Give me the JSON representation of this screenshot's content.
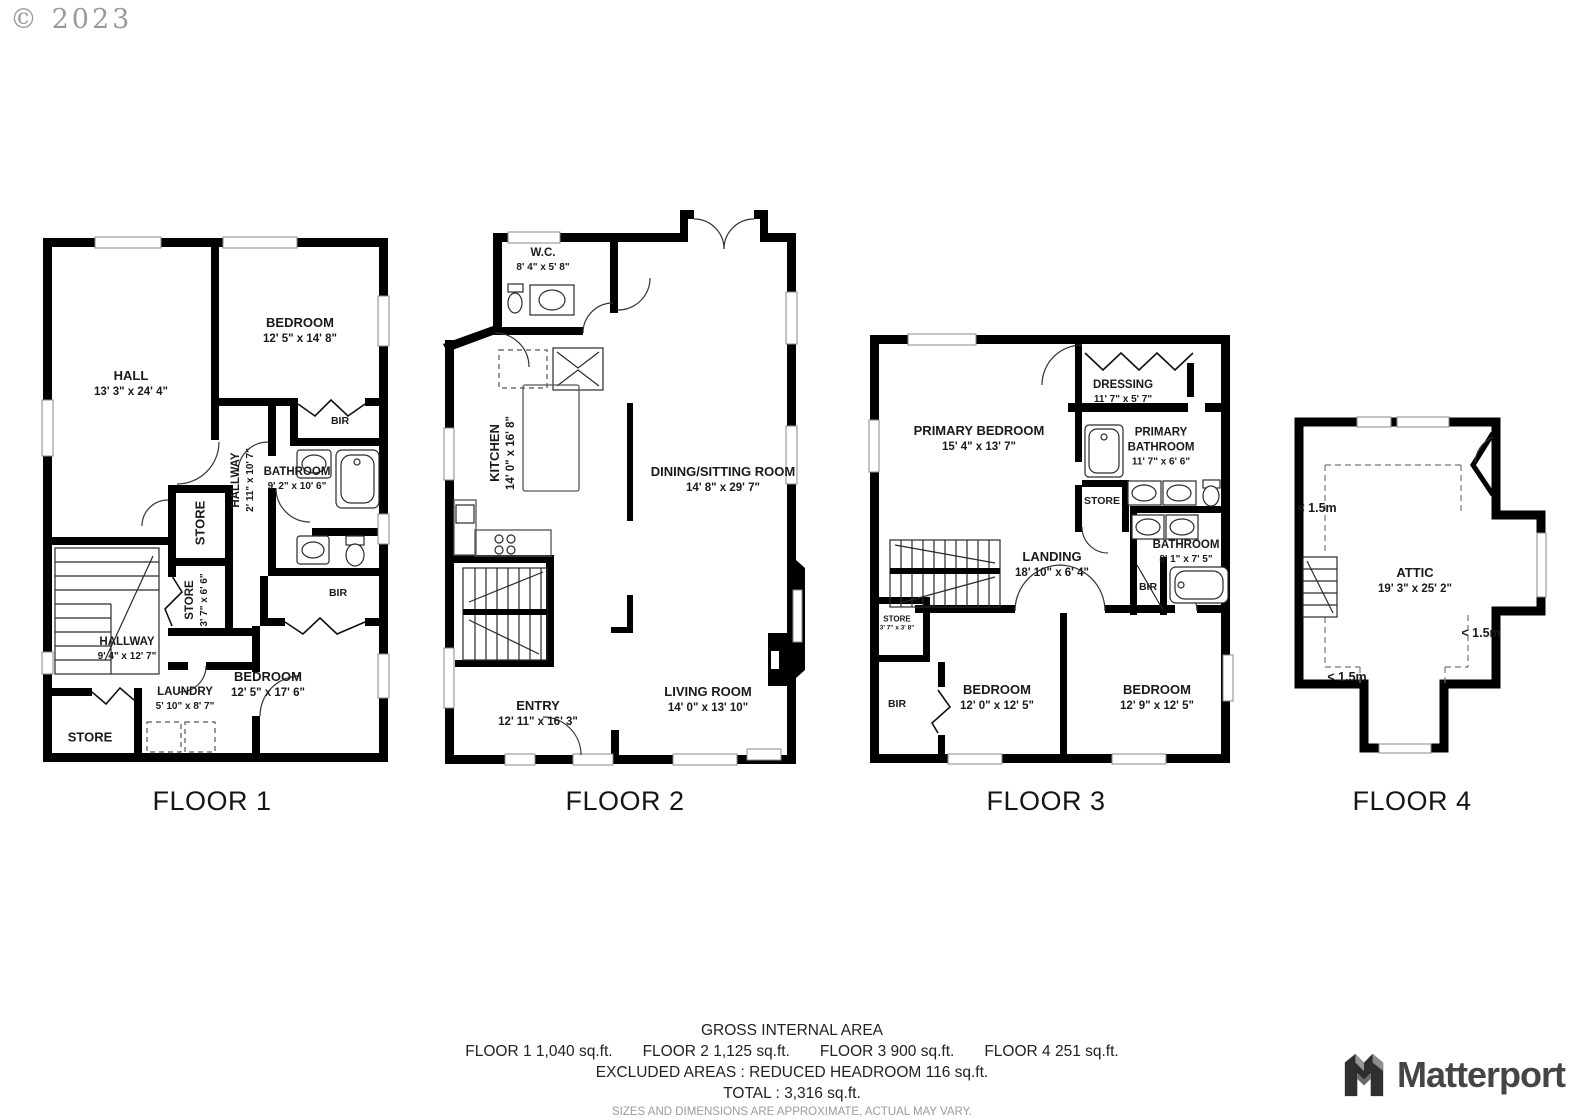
{
  "meta": {
    "copyright": "© 2023"
  },
  "floors": [
    {
      "label": "FLOOR 1",
      "rooms": {
        "hall": {
          "name": "HALL",
          "dims": "13' 3\" x 24' 4\""
        },
        "bedroom1": {
          "name": "BEDROOM",
          "dims": "12' 5\" x 14' 8\""
        },
        "bir1": {
          "name": "BIR"
        },
        "hallway1": {
          "name": "HALLWAY",
          "dims": "2' 11\" x 10' 7\""
        },
        "bathroom": {
          "name": "BATHROOM",
          "dims": "9' 2\" x 10' 6\""
        },
        "store1": {
          "name": "STORE"
        },
        "store2": {
          "name": "STORE",
          "dims": "3' 7\" x 6' 6\""
        },
        "hallway2": {
          "name": "HALLWAY",
          "dims": "9' 4\" x 12' 7\""
        },
        "laundry": {
          "name": "LAUNDRY",
          "dims": "5' 10\" x 8' 7\""
        },
        "bir2": {
          "name": "BIR"
        },
        "bedroom2": {
          "name": "BEDROOM",
          "dims": "12' 5\" x 17' 6\""
        },
        "store3": {
          "name": "STORE"
        }
      }
    },
    {
      "label": "FLOOR 2",
      "rooms": {
        "wc": {
          "name": "W.C.",
          "dims": "8' 4\" x 5' 8\""
        },
        "kitchen": {
          "name": "KITCHEN",
          "dims": "14' 0\" x 16' 8\""
        },
        "dining": {
          "name": "DINING/SITTING ROOM",
          "dims": "14' 8\" x 29' 7\""
        },
        "entry": {
          "name": "ENTRY",
          "dims": "12' 11\" x 16' 3\""
        },
        "living": {
          "name": "LIVING ROOM",
          "dims": "14' 0\" x 13' 10\""
        }
      }
    },
    {
      "label": "FLOOR 3",
      "rooms": {
        "primary_bedroom": {
          "name": "PRIMARY BEDROOM",
          "dims": "15' 4\" x 13' 7\""
        },
        "dressing": {
          "name": "DRESSING",
          "dims": "11' 7\" x 5' 7\""
        },
        "primary_bathroom": {
          "name": "PRIMARY BATHROOM",
          "dims": "11' 7\" x 6' 6\""
        },
        "store": {
          "name": "STORE"
        },
        "bathroom": {
          "name": "BATHROOM",
          "dims": "8' 1\" x 7' 5\""
        },
        "landing": {
          "name": "LANDING",
          "dims": "18' 10\" x 6' 4\""
        },
        "store_small": {
          "name": "STORE",
          "dims": "3' 7\" x 3' 8\""
        },
        "bir_left": {
          "name": "BIR"
        },
        "bir_right": {
          "name": "BIR"
        },
        "bedroom1": {
          "name": "BEDROOM",
          "dims": "12' 0\" x 12' 5\""
        },
        "bedroom2": {
          "name": "BEDROOM",
          "dims": "12' 9\" x 12' 5\""
        }
      }
    },
    {
      "label": "FLOOR 4",
      "rooms": {
        "attic": {
          "name": "ATTIC",
          "dims": "19' 3\" x 25' 2\""
        }
      },
      "headroom_labels": [
        "< 1.5m",
        "< 1.5m",
        "< 1.5m"
      ]
    }
  ],
  "footer": {
    "title": "GROSS INTERNAL AREA",
    "areas": [
      "FLOOR 1 1,040 sq.ft.",
      "FLOOR 2 1,125 sq.ft.",
      "FLOOR 3 900 sq.ft.",
      "FLOOR 4 251 sq.ft."
    ],
    "excluded": "EXCLUDED AREAS :  REDUCED HEADROOM 116 sq.ft.",
    "total": "TOTAL :  3,316 sq.ft.",
    "disclaimer": "SIZES AND DIMENSIONS ARE APPROXIMATE, ACTUAL MAY VARY."
  },
  "brand": {
    "wordmark": "Matterport"
  },
  "colors": {
    "wall": "#000000",
    "window": "#8a8a8a",
    "text": "#1a1a1a",
    "muted": "#9b9b9b"
  }
}
